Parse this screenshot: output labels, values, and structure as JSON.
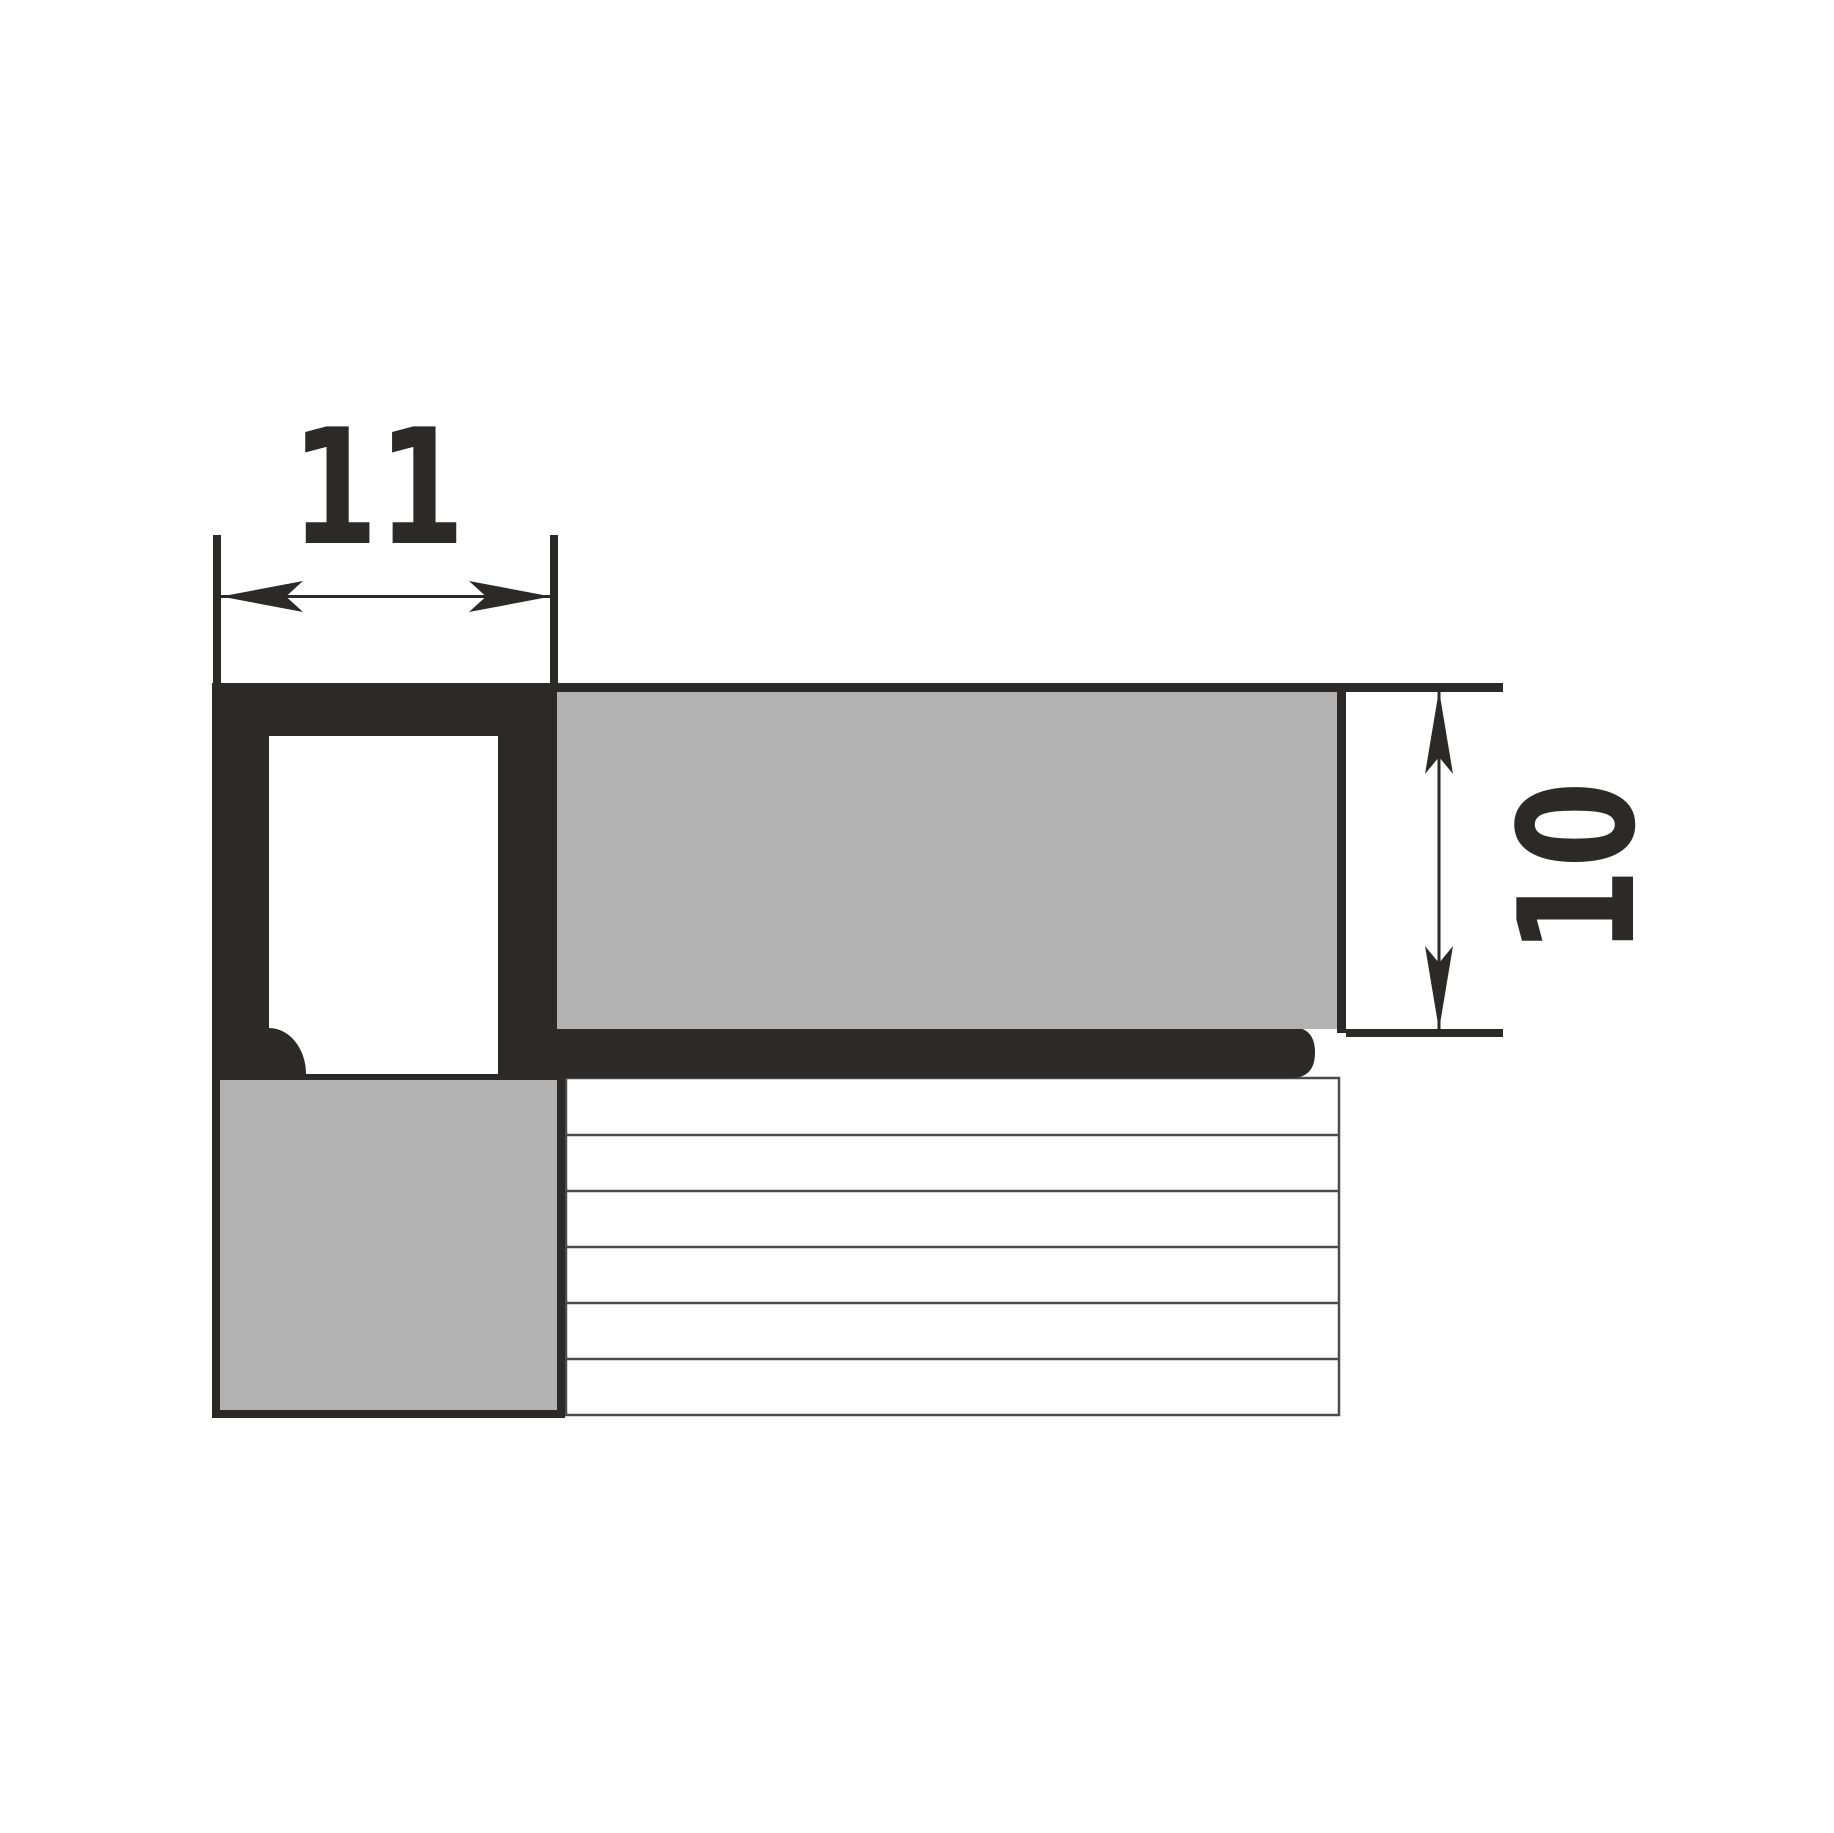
{
  "drawing": {
    "dimensions": {
      "width": "11",
      "height": "10"
    }
  },
  "colors": {
    "ink": "#2B2A29",
    "tile": "#B2B2B2",
    "hatch": "#4B4B4B",
    "cavity": "#FFFFFF",
    "bg": "#FFFFFF"
  }
}
